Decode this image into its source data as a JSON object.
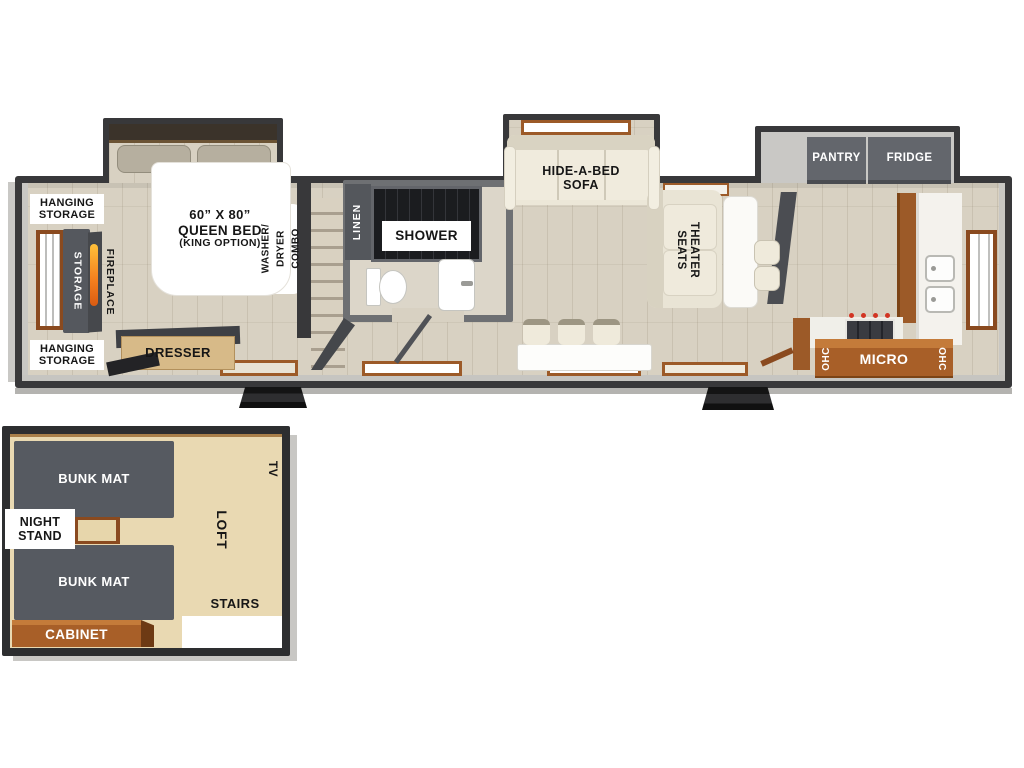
{
  "colors": {
    "wall": "#3a3a3c",
    "floor_wood": "#d8d1c2",
    "loft_floor": "#e9d9b2",
    "cabinet_brown": "#a85f28",
    "frame_brown": "#8a4a1f",
    "unit_gray": "#575b62",
    "cream": "#eae5d6",
    "label_text": "#161616"
  },
  "main": {
    "bedroom": {
      "hanging_storage_top": {
        "line1": "HANGING",
        "line2": "STORAGE"
      },
      "hanging_storage_bottom": {
        "line1": "HANGING",
        "line2": "STORAGE"
      },
      "storage": "STORAGE",
      "fireplace": "FIREPLACE",
      "bed": {
        "line1": "60” X 80”",
        "line2": "QUEEN BED",
        "line3": "(KING OPTION)"
      },
      "washer": {
        "line1": "WASHER/",
        "line2": "DRYER",
        "line3": "COMBO"
      },
      "dresser": "DRESSER"
    },
    "bath": {
      "linen": "LINEN",
      "shower": "SHOWER"
    },
    "living": {
      "sofa": {
        "line1": "HIDE-A-BED",
        "line2": "SOFA"
      },
      "theater": {
        "line1": "THEATER",
        "line2": "SEATS"
      }
    },
    "kitchen": {
      "pantry": "PANTRY",
      "fridge": "FRIDGE",
      "ohc_left": "OHC",
      "micro": "MICRO",
      "ohc_right": "OHC"
    }
  },
  "loft": {
    "bunk_top": "BUNK MAT",
    "night_stand": {
      "line1": "NIGHT",
      "line2": "STAND"
    },
    "bunk_bottom": "BUNK MAT",
    "cabinet": "CABINET",
    "loft": "LOFT",
    "tv": "TV",
    "stairs": "STAIRS"
  }
}
